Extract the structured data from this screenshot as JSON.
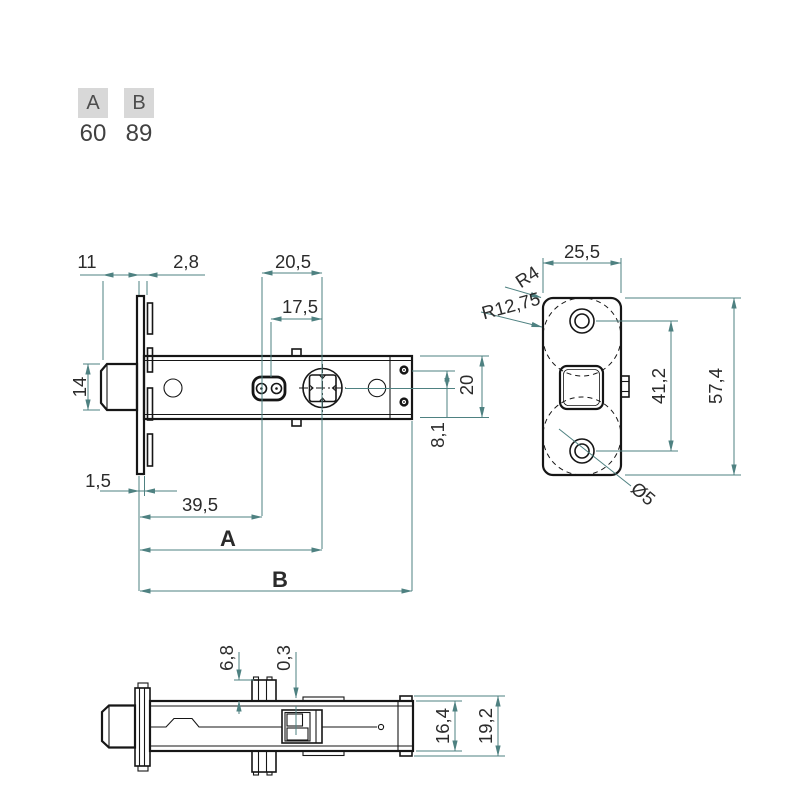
{
  "parameter_table": {
    "columns": [
      {
        "header": "A",
        "value": "60"
      },
      {
        "header": "B",
        "value": "89"
      }
    ]
  },
  "side_view": {
    "dims": {
      "protrusion": "11",
      "plate_thickness": "2,8",
      "follower_span": "20,5",
      "hub_span": "17,5",
      "bolt_height": "14",
      "case_height": "20",
      "offset": "8,1",
      "lip": "1,5",
      "hole_distance": "39,5",
      "backset": "A",
      "overall": "B"
    }
  },
  "front_view": {
    "dims": {
      "plate_width": "25,5",
      "corner_radius": "R4",
      "end_radius": "R12,75",
      "screw_spacing": "41,2",
      "plate_height": "57,4",
      "screw_hole": "Ø5"
    }
  },
  "bottom_view": {
    "dims": {
      "lug_height": "6,8",
      "clearance": "0,3",
      "case_width": "16,4",
      "overall_width": "19,2"
    }
  },
  "colors": {
    "dimension_line": "#4e8181",
    "drawing_ink": "#161616",
    "dimension_text": "#2b2b2b",
    "table_header_bg": "#d8d8d8",
    "table_text": "#414141",
    "background": "#ffffff"
  }
}
